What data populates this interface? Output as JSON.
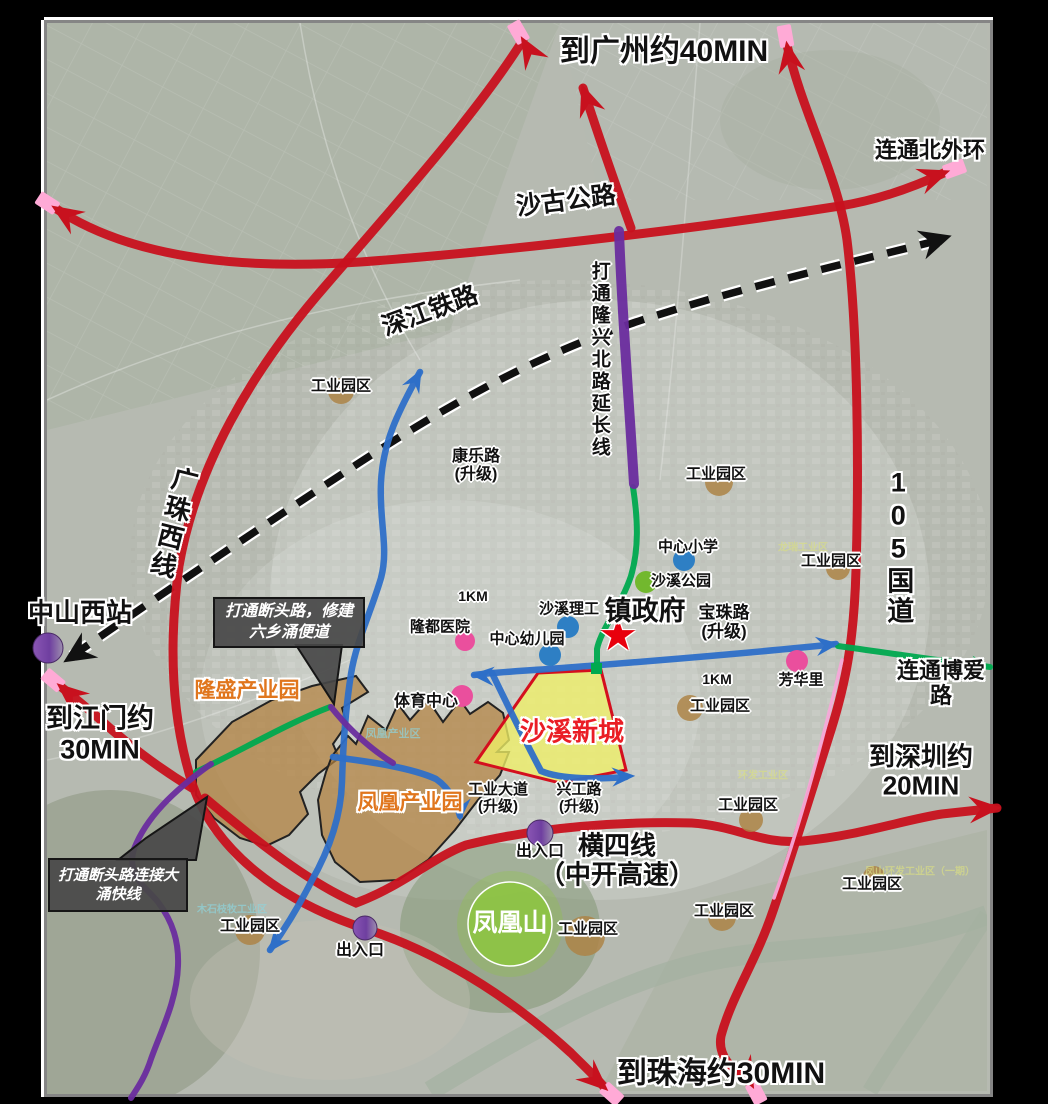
{
  "map_title": "沙溪镇交通规划示意图",
  "frame": {
    "page_bg": "#000000",
    "border_color": "#858585",
    "edge_highlight": "#ffffff"
  },
  "palette": {
    "red_road": "#c8111e",
    "blue_road": "#2e6fc8",
    "green_road": "#00a94f",
    "purple_road": "#6a2c9e",
    "pink_tip": "#ffaad6",
    "pink_line": "#f7a8d8",
    "rail_black": "#111111",
    "tan_circle": "#ad8446",
    "dot_blue": "#2e7fc4",
    "dot_green": "#72b82e",
    "dot_pink": "#ea4f9d",
    "purple_a": "#8a56b4",
    "purple_b": "#9d8fae",
    "yellow_area": "#efef66",
    "yellow_border": "#d40f1e",
    "brown_area": "#b3813f",
    "phoenix_green": "#8dc63f",
    "star_red": "#e8000d",
    "callout_bg": "#484848"
  },
  "areas": [
    {
      "id": "longsheng-industrial-park",
      "path": "M196,760 L232,722 L272,700 L312,686 L356,676 L368,692 L342,708 L347,724 L333,744 L339,758 L318,774 L300,792 L308,814 L289,835 L266,846 L240,838 L214,818 L196,795 Z",
      "fill": "brown",
      "opacity": 0.72
    },
    {
      "id": "fenghuang-industrial-park",
      "path": "M318,800 L326,772 L332,756 L348,736 L356,744 L368,716 L386,730 L398,704 L410,720 L428,700 L443,722 L460,700 L470,714 L488,702 L503,713 L509,740 L497,752 L509,752 L500,775 L478,800 L455,830 L428,860 L398,880 L360,882 L335,862 L322,835 Z",
      "fill": "brown",
      "opacity": 0.72
    },
    {
      "id": "shaxi-new-town",
      "path": "M538,673 L601,670 L626,770 L560,783 L476,762 Z",
      "fill": "yellow",
      "opacity": 0.78
    }
  ],
  "railway": {
    "id": "shenjiang-railway",
    "path": "M72,656 C150,602 262,526 362,461 C462,396 545,352 642,320 C740,288 852,262 940,240",
    "dash": "20 14",
    "width": 7.5,
    "casing": 12,
    "arrows": [
      {
        "x": 70,
        "y": 658,
        "a": 147
      },
      {
        "x": 944,
        "y": 238,
        "a": -17
      }
    ]
  },
  "roads": [
    {
      "id": "shaguo-highway",
      "color": "red_road",
      "w": 9,
      "path": "M55,208 C130,258 240,270 360,262 C520,250 700,228 840,206 C878,200 912,188 946,172",
      "arrows": [
        {
          "x": 55,
          "y": 208,
          "a": -147,
          "pink": true
        },
        {
          "x": 946,
          "y": 172,
          "a": -20,
          "pink": true
        }
      ]
    },
    {
      "id": "g105-national-road",
      "color": "red_road",
      "w": 9,
      "path": "M787,45 C803,115 838,175 847,240 C858,330 859,470 856,570 C854,640 846,682 831,730 C812,790 791,858 774,908 C756,962 732,995 721,1036 C717,1058 734,1070 752,1085",
      "arrows": [
        {
          "x": 787,
          "y": 45,
          "a": -100,
          "pink": true
        },
        {
          "x": 752,
          "y": 1085,
          "a": 62,
          "pink": true
        }
      ]
    },
    {
      "id": "guangzhu-west-line",
      "color": "red_road",
      "w": 9,
      "path": "M523,40 C478,112 396,204 327,284 C250,372 196,468 179,566 C168,648 172,722 193,786 C216,852 282,902 366,929 C452,957 522,1008 571,1053 C584,1066 596,1077 605,1088",
      "arrows": [
        {
          "x": 523,
          "y": 40,
          "a": -120,
          "pink": true
        },
        {
          "x": 605,
          "y": 1088,
          "a": 42,
          "pink": true
        }
      ]
    },
    {
      "id": "longxing-north-road",
      "color": "red_road",
      "w": 9,
      "path": "M583,88 C599,138 616,186 631,228",
      "arrows": [
        {
          "x": 583,
          "y": 88,
          "a": -110,
          "pink": false
        }
      ]
    },
    {
      "id": "hengsi-expressway",
      "color": "red_road",
      "w": 9,
      "path": "M205,798 C262,846 312,884 356,903 C402,886 432,858 466,845 C540,827 622,821 692,823 C737,826 762,845 803,841 C862,835 903,820 942,814 L997,808",
      "arrows": [
        {
          "x": 997,
          "y": 808,
          "a": -4,
          "pink": false
        }
      ]
    },
    {
      "id": "jiangmen-road",
      "color": "red_road",
      "w": 9,
      "path": "M192,788 C152,764 118,736 94,714 C82,704 70,694 60,686",
      "arrows": [
        {
          "x": 60,
          "y": 686,
          "a": -140,
          "pink": true
        }
      ]
    },
    {
      "id": "pink-parallel-line",
      "color": "pink_line",
      "w": 3.5,
      "path": "M842,660 C823,740 799,828 774,898",
      "arrows": []
    },
    {
      "id": "kangle-road",
      "color": "blue_road",
      "w": 6.5,
      "path": "M420,372 C398,412 383,442 381,482 C379,522 389,548 381,578 C371,612 356,642 351,674 C345,712 343,747 342,782 C341,814 331,847 311,882 C299,906 284,930 270,950",
      "arrows": [
        {
          "x": 420,
          "y": 372,
          "a": -62
        },
        {
          "x": 270,
          "y": 950,
          "a": 128
        }
      ]
    },
    {
      "id": "baozhu-road",
      "color": "blue_road",
      "w": 6.5,
      "path": "M836,644 C762,652 652,661 562,668 C523,671 497,672 474,675",
      "arrows": [
        {
          "x": 474,
          "y": 675,
          "a": 184
        },
        {
          "x": 836,
          "y": 644,
          "a": -7
        }
      ]
    },
    {
      "id": "xinggong-road",
      "color": "blue_road",
      "w": 6.5,
      "path": "M492,673 C506,702 521,733 541,771 C562,780 601,779 626,777",
      "arrows": [
        {
          "x": 632,
          "y": 776,
          "a": -3
        }
      ]
    },
    {
      "id": "gongye-avenue",
      "color": "blue_road",
      "w": 6.5,
      "path": "M333,757 C372,762 412,768 436,779 C452,790 457,806 460,816",
      "arrows": [
        {
          "x": 460,
          "y": 818,
          "a": 93
        }
      ]
    },
    {
      "id": "longxing-extension-green",
      "color": "green_road",
      "w": 6,
      "path": "M633,487 C638,520 639,549 631,576 C621,606 601,629 597,649 L597,668",
      "arrows": []
    },
    {
      "id": "boai-road-link",
      "color": "green_road",
      "w": 6,
      "path": "M838,646 C882,652 934,660 990,667",
      "arrows": [
        {
          "x": 990,
          "y": 667,
          "a": 7
        }
      ]
    },
    {
      "id": "longsheng-green-road",
      "color": "green_road",
      "w": 6,
      "path": "M196,772 C242,750 288,723 330,707",
      "arrows": []
    },
    {
      "id": "longxing-extension-purple",
      "color": "purple_road",
      "w": 10,
      "path": "M619,231 C622,315 629,400 634,484",
      "arrows": []
    },
    {
      "id": "purple-link-road",
      "color": "purple_road",
      "w": 6,
      "path": "M331,707 C347,727 366,746 393,763",
      "arrows": []
    },
    {
      "id": "dayong-express-link",
      "color": "purple_road",
      "w": 6,
      "path": "M211,764 C172,792 146,818 134,849 C126,876 146,887 158,902 C173,922 179,942 178,966 C177,1000 161,1031 151,1059 C145,1078 136,1090 131,1098",
      "arrows": []
    }
  ],
  "markers": {
    "tan_circles": [
      {
        "x": 341,
        "y": 391,
        "r": 13
      },
      {
        "x": 719,
        "y": 482,
        "r": 14
      },
      {
        "x": 838,
        "y": 568,
        "r": 12
      },
      {
        "x": 690,
        "y": 708,
        "r": 13
      },
      {
        "x": 751,
        "y": 820,
        "r": 12
      },
      {
        "x": 874,
        "y": 877,
        "r": 11
      },
      {
        "x": 585,
        "y": 936,
        "r": 20
      },
      {
        "x": 722,
        "y": 917,
        "r": 14
      },
      {
        "x": 250,
        "y": 930,
        "r": 15
      }
    ],
    "blue_dots": [
      {
        "x": 684,
        "y": 560,
        "r": 11
      },
      {
        "x": 568,
        "y": 627,
        "r": 11
      },
      {
        "x": 550,
        "y": 655,
        "r": 11
      }
    ],
    "green_dots": [
      {
        "x": 646,
        "y": 582,
        "r": 11
      }
    ],
    "pink_dots": [
      {
        "x": 465,
        "y": 641,
        "r": 10
      },
      {
        "x": 462,
        "y": 696,
        "r": 11
      },
      {
        "x": 797,
        "y": 661,
        "r": 11
      }
    ],
    "purple_circles": [
      {
        "id": "zhongshan-west-station",
        "x": 48,
        "y": 648,
        "r": 15
      },
      {
        "id": "exit-east",
        "x": 540,
        "y": 833,
        "r": 13
      },
      {
        "id": "exit-west",
        "x": 365,
        "y": 928,
        "r": 12
      }
    ],
    "phoenix_mountain": {
      "x": 510,
      "y": 924,
      "r": 42,
      "halo_r": 53
    },
    "green_square": {
      "x": 591,
      "y": 663,
      "w": 11,
      "h": 11
    },
    "gov_star": {
      "x": 618,
      "y": 636,
      "glyph": "★"
    }
  },
  "callouts": [
    {
      "id": "liuxiang-bypass",
      "text": "打通断头路，修建\n六乡涌便道",
      "x": 213,
      "y": 597,
      "w": 152,
      "h": 51,
      "size": 16,
      "pointer": "M296,645 L342,645 L334,704 Z"
    },
    {
      "id": "dayong-express",
      "text": "打通断头路连接大\n涌快线",
      "x": 48,
      "y": 858,
      "w": 140,
      "h": 54,
      "size": 15,
      "pointer": "M118,860 L196,860 L207,797 L146,838 Z"
    }
  ],
  "labels": [
    {
      "id": "to-guangzhou",
      "text": "到广州约40MIN",
      "x": 664,
      "y": 52,
      "size": 30,
      "cls": "halo"
    },
    {
      "id": "link-north-outer-ring",
      "text": "连通北外环",
      "x": 930,
      "y": 151,
      "size": 22,
      "cls": "halo"
    },
    {
      "id": "shaguo-highway",
      "text": "沙古公路",
      "x": 566,
      "y": 201,
      "size": 25,
      "cls": "halo",
      "rot": -7
    },
    {
      "id": "shenjiang-railway",
      "text": "深江铁路",
      "x": 430,
      "y": 311,
      "size": 25,
      "cls": "halo",
      "rot": -20
    },
    {
      "id": "longxing-extension",
      "text": "打通隆兴北路延长线",
      "x": 599,
      "y": 360,
      "size": 19,
      "cls": "halo1 vert"
    },
    {
      "id": "guangzhu-west-line",
      "text": "广珠西线",
      "x": 172,
      "y": 523,
      "size": 26,
      "cls": "halo vert",
      "rot": 14
    },
    {
      "id": "g105",
      "text": "105国道",
      "x": 898,
      "y": 547,
      "size": 27,
      "cls": "halo vert"
    },
    {
      "id": "zhongshan-west-station",
      "text": "中山西站",
      "x": 80,
      "y": 613,
      "size": 26,
      "cls": "halo"
    },
    {
      "id": "to-jiangmen",
      "text": "到江门约\n30MIN",
      "x": 100,
      "y": 734,
      "size": 27,
      "cls": "halo"
    },
    {
      "id": "to-shenzhen",
      "text": "到深圳约20MIN",
      "x": 921,
      "y": 772,
      "size": 26,
      "cls": "halo"
    },
    {
      "id": "to-zhuhai",
      "text": "到珠海约30MIN",
      "x": 721,
      "y": 1074,
      "size": 30,
      "cls": "halo"
    },
    {
      "id": "hengsi-line",
      "text": "横四线\n（中开高速）",
      "x": 617,
      "y": 861,
      "size": 26,
      "cls": "halo"
    },
    {
      "id": "town-government",
      "text": "镇政府",
      "x": 645,
      "y": 611,
      "size": 27,
      "cls": "halo"
    },
    {
      "id": "link-boai-road",
      "text": "连通博爱路",
      "x": 941,
      "y": 684,
      "size": 22,
      "cls": "halo"
    },
    {
      "id": "longsheng-park",
      "text": "隆盛产业园",
      "x": 247,
      "y": 691,
      "size": 21,
      "cls": "halo",
      "color": "#e0761d"
    },
    {
      "id": "fenghuang-park",
      "text": "凤凰产业园",
      "x": 410,
      "y": 803,
      "size": 21,
      "cls": "halo",
      "color": "#e0761d"
    },
    {
      "id": "shaxi-new-town",
      "text": "沙溪新城",
      "x": 572,
      "y": 732,
      "size": 26,
      "cls": "halo",
      "color": "#ea1d25"
    },
    {
      "id": "phoenix-mountain",
      "text": "凤凰山",
      "x": 510,
      "y": 923,
      "size": 25,
      "color": "#ffffff"
    },
    {
      "id": "kangle-road",
      "text": "康乐路\n(升级)",
      "x": 476,
      "y": 466,
      "size": 16,
      "cls": "halo1"
    },
    {
      "id": "central-primary-school",
      "text": "中心小学",
      "x": 688,
      "y": 548,
      "size": 15,
      "cls": "halo1"
    },
    {
      "id": "shaxi-park",
      "text": "沙溪公园",
      "x": 681,
      "y": 582,
      "size": 15,
      "cls": "halo1"
    },
    {
      "id": "shaxi-polytechnic",
      "text": "沙溪理工",
      "x": 569,
      "y": 610,
      "size": 15,
      "cls": "halo1"
    },
    {
      "id": "central-kindergarten",
      "text": "中心幼儿园",
      "x": 527,
      "y": 640,
      "size": 15,
      "cls": "halo1"
    },
    {
      "id": "longdu-hospital",
      "text": "隆都医院",
      "x": 440,
      "y": 628,
      "size": 15,
      "cls": "halo1"
    },
    {
      "id": "sports-center",
      "text": "体育中心",
      "x": 426,
      "y": 702,
      "size": 16,
      "cls": "halo1"
    },
    {
      "id": "baozhu-road",
      "text": "宝珠路\n(升级)",
      "x": 724,
      "y": 622,
      "size": 17,
      "cls": "halo1"
    },
    {
      "id": "fanghuali",
      "text": "芳华里",
      "x": 801,
      "y": 681,
      "size": 15,
      "cls": "halo1"
    },
    {
      "id": "gongye-avenue",
      "text": "工业大道\n(升级)",
      "x": 498,
      "y": 799,
      "size": 15,
      "cls": "halo1"
    },
    {
      "id": "xinggong-road",
      "text": "兴工路\n(升级)",
      "x": 579,
      "y": 799,
      "size": 15,
      "cls": "halo1"
    },
    {
      "id": "exit-east",
      "text": "出入口",
      "x": 540,
      "y": 852,
      "size": 16,
      "cls": "halo1"
    },
    {
      "id": "exit-west",
      "text": "出入口",
      "x": 360,
      "y": 951,
      "size": 16,
      "cls": "halo1"
    },
    {
      "id": "scale-1km-a",
      "text": "1KM",
      "x": 473,
      "y": 597,
      "size": 14,
      "cls": "halo1"
    },
    {
      "id": "scale-1km-b",
      "text": "1KM",
      "x": 717,
      "y": 680,
      "size": 14,
      "cls": "halo1"
    },
    {
      "id": "industrial-park-1",
      "text": "工业园区",
      "x": 341,
      "y": 387,
      "size": 15,
      "cls": "halo1"
    },
    {
      "id": "industrial-park-2",
      "text": "工业园区",
      "x": 716,
      "y": 475,
      "size": 15,
      "cls": "halo1"
    },
    {
      "id": "industrial-park-3",
      "text": "工业园区",
      "x": 831,
      "y": 562,
      "size": 15,
      "cls": "halo1"
    },
    {
      "id": "industrial-park-4",
      "text": "工业园区",
      "x": 720,
      "y": 707,
      "size": 15,
      "cls": "halo1"
    },
    {
      "id": "industrial-park-5",
      "text": "工业园区",
      "x": 748,
      "y": 806,
      "size": 15,
      "cls": "halo1"
    },
    {
      "id": "industrial-park-6",
      "text": "工业园区",
      "x": 872,
      "y": 885,
      "size": 15,
      "cls": "halo1"
    },
    {
      "id": "industrial-park-7",
      "text": "工业园区",
      "x": 588,
      "y": 930,
      "size": 15,
      "cls": "halo1"
    },
    {
      "id": "industrial-park-8",
      "text": "工业园区",
      "x": 724,
      "y": 912,
      "size": 15,
      "cls": "halo1"
    },
    {
      "id": "industrial-park-9",
      "text": "工业园区",
      "x": 250,
      "y": 927,
      "size": 15,
      "cls": "halo1"
    },
    {
      "id": "bg-fenghuang-zone",
      "text": "凤凰产业区",
      "x": 393,
      "y": 734,
      "size": 11,
      "cls": "faint",
      "color": "#8fd4dc"
    },
    {
      "id": "bg-mushizhimu-zone",
      "text": "木石枝牧工业区",
      "x": 232,
      "y": 910,
      "size": 10,
      "cls": "faint",
      "color": "#8fd4dc"
    },
    {
      "id": "bg-longrui-zone",
      "text": "龙瑞工业区",
      "x": 803,
      "y": 548,
      "size": 10,
      "cls": "faint",
      "color": "#d9de85"
    },
    {
      "id": "bg-fengshan-zone",
      "text": "凤山环发工业区（一期）",
      "x": 920,
      "y": 872,
      "size": 10,
      "cls": "faint",
      "color": "#d9de85"
    },
    {
      "id": "bg-huanfa-zone",
      "text": "环发工业区",
      "x": 763,
      "y": 776,
      "size": 10,
      "cls": "faint",
      "color": "#d9de85"
    }
  ]
}
